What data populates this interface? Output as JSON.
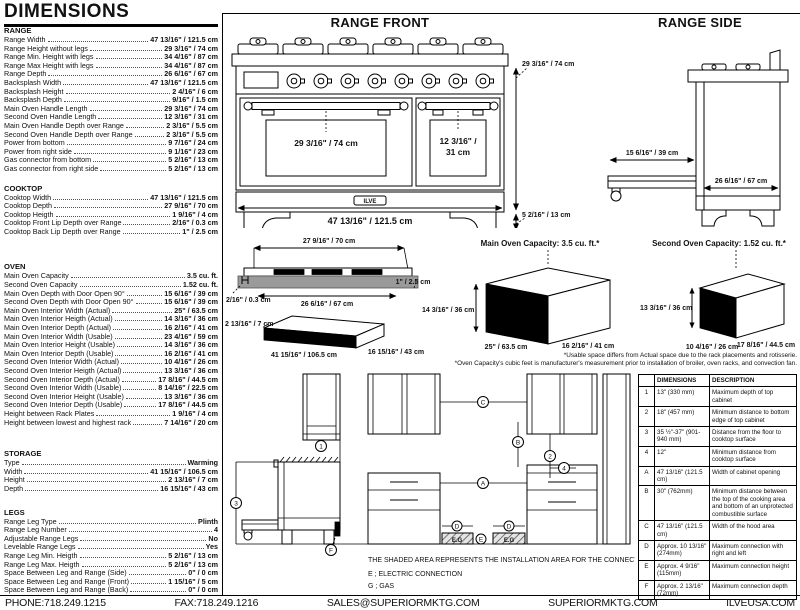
{
  "page": {
    "title": "DIMENSIONS"
  },
  "sections": {
    "range": {
      "heading": "RANGE",
      "rows": [
        {
          "label": "Range Width",
          "value": "47 13/16\" / 121.5 cm"
        },
        {
          "label": "Range Height without legs",
          "value": "29 3/16\" / 74 cm"
        },
        {
          "label": "Range Min. Height with legs",
          "value": "34 4/16\" / 87 cm"
        },
        {
          "label": "Range Max Height with legs",
          "value": "34 4/16\" / 87 cm"
        },
        {
          "label": "Range Depth",
          "value": "26 6/16\" / 67 cm"
        },
        {
          "label": "Backsplash Width",
          "value": "47 13/16\" / 121.5 cm"
        },
        {
          "label": "Backsplash Height",
          "value": "2 4/16\" / 6 cm"
        },
        {
          "label": "Backsplash Depth",
          "value": "9/16\" / 1.5 cm"
        },
        {
          "label": "Main Oven Handle Length",
          "value": "29 3/16\" / 74 cm"
        },
        {
          "label": "Second Oven Handle Length",
          "value": "12 3/16\" / 31 cm"
        },
        {
          "label": "Main Oven Handle Depth over Range",
          "value": "2 3/16\" / 5.5 cm"
        },
        {
          "label": "Second Oven Handle Depth over Range",
          "value": "2 3/16\" / 5.5 cm"
        },
        {
          "label": "Power from bottom",
          "value": "9 7/16\" / 24 cm"
        },
        {
          "label": "Power from right side",
          "value": "9 1/16\" / 23 cm"
        },
        {
          "label": "Gas connector from bottom",
          "value": "5 2/16\" / 13 cm"
        },
        {
          "label": "Gas connector from right side",
          "value": "5 2/16\" / 13 cm"
        }
      ]
    },
    "cooktop": {
      "heading": "COOKTOP",
      "rows": [
        {
          "label": "Cooktop Width",
          "value": "47 13/16\" / 121.5 cm"
        },
        {
          "label": "Cooktop Depth",
          "value": "27 9/16\" / 70 cm"
        },
        {
          "label": "Cooktop Heigth",
          "value": "1 9/16\" / 4 cm"
        },
        {
          "label": "Cooktop Front Lip Depth over Range",
          "value": "2/16\" / 0.3 cm"
        },
        {
          "label": "Cooktop Back Lip Depth over Range",
          "value": "1\" / 2.5 cm"
        }
      ]
    },
    "oven": {
      "heading": "OVEN",
      "rows": [
        {
          "label": "Main Oven Capacity",
          "value": "3.5 cu. ft."
        },
        {
          "label": "Second Oven Capacity",
          "value": "1.52 cu. ft."
        },
        {
          "label": "Main Oven Depth with Door Open 90°",
          "value": "15 6/16\" / 39 cm"
        },
        {
          "label": "Second Oven Depth with Door Open 90°",
          "value": "15 6/16\" / 39 cm"
        },
        {
          "label": "Main Oven Interior Width (Actual)",
          "value": "25\" / 63.5 cm"
        },
        {
          "label": "Main Oven Interior Heigth (Actual)",
          "value": "14 3/16\" / 36 cm"
        },
        {
          "label": "Main Oven Interior Depth (Actual)",
          "value": "16 2/16\" / 41 cm"
        },
        {
          "label": "Main Oven Interior Width (Usable)",
          "value": "23 4/16\" / 59 cm"
        },
        {
          "label": "Main Oven Interior Height (Usable)",
          "value": "14 3/16\" / 36 cm"
        },
        {
          "label": "Main Oven Interior Depth (Usable)",
          "value": "16 2/16\" / 41 cm"
        },
        {
          "label": "Second Oven Interior Width (Actual)",
          "value": "10 4/16\" / 26 cm"
        },
        {
          "label": "Second Oven Interior Heigth (Actual)",
          "value": "13 3/16\" / 36 cm"
        },
        {
          "label": "Second Oven Interior Depth (Actual)",
          "value": "17 8/16\" / 44.5 cm"
        },
        {
          "label": "Second Oven Interior Width (Usable)",
          "value": "8 14/16\" / 22.5 cm"
        },
        {
          "label": "Second Oven Interior Height (Usable)",
          "value": "13 3/16\" / 36 cm"
        },
        {
          "label": "Second Oven Interior Depth (Usable)",
          "value": "17 8/16\" / 44.5 cm"
        },
        {
          "label": "Height between Rack Plates",
          "value": "1 9/16\" / 4 cm"
        },
        {
          "label": "Height between lowest and highest rack",
          "value": "7 14/16\" / 20 cm"
        }
      ]
    },
    "storage": {
      "heading": "STORAGE",
      "rows": [
        {
          "label": "Type",
          "value": "Warming"
        },
        {
          "label": "Width",
          "value": "41 15/16\" / 106.5 cm"
        },
        {
          "label": "Height",
          "value": "2 13/16\" / 7 cm"
        },
        {
          "label": "Depth",
          "value": "16 15/16\" / 43 cm"
        }
      ]
    },
    "legs": {
      "heading": "LEGS",
      "rows": [
        {
          "label": "Range Leg Type",
          "value": "Plinth"
        },
        {
          "label": "Range Leg Number",
          "value": "4"
        },
        {
          "label": "Adjustable Range Legs",
          "value": "No"
        },
        {
          "label": "Levelable Range Legs",
          "value": "Yes"
        },
        {
          "label": "Range Leg Min. Heigth",
          "value": "5 2/16\" / 13 cm"
        },
        {
          "label": "Range Leg Max. Heigth",
          "value": "5 2/16\" / 13 cm"
        },
        {
          "label": "Space Between Leg and Range (Side)",
          "value": "0\" / 0 cm"
        },
        {
          "label": "Space Between Leg and Range (Front)",
          "value": "1 15/16\" / 5 cm"
        },
        {
          "label": "Space Between Leg and Range (Back)",
          "value": "0\" / 0 cm"
        }
      ]
    }
  },
  "drawings": {
    "front": {
      "title": "RANGE FRONT",
      "main_handle": "29 3/16\" / 74 cm",
      "second_handle_l1": "12 3/16\" /",
      "second_handle_l2": "31 cm",
      "width": "47 13/16\" / 121.5 cm",
      "height": "29 3/16\" / 74 cm",
      "leg_height": "5 2/16\" / 13 cm",
      "logo": "ILVE"
    },
    "side": {
      "title": "RANGE SIDE",
      "door_open_depth": "15 6/16\" / 39 cm",
      "depth": "26 6/16\" / 67 cm"
    },
    "cooktop": {
      "width": "27 9/16\" / 70 cm",
      "inner_width": "26 6/16\" / 67 cm",
      "back_lip": "1\" / 2.5 cm",
      "front_lip": "2/16\" / 0.3 cm"
    },
    "storage": {
      "height": "2 13/16\" / 7 cm",
      "width": "41 15/16\" / 106.5 cm",
      "depth": "16 15/16\" / 43 cm"
    },
    "main_oven": {
      "title": "Main Oven Capacity: 3.5 cu. ft.*",
      "height": "14 3/16\" / 36 cm",
      "width": "25\" / 63.5 cm",
      "depth": "16 2/16\" / 41 cm"
    },
    "second_oven": {
      "title": "Second Oven Capacity: 1.52 cu. ft.*",
      "height": "13 3/16\" / 36 cm",
      "width": "10 4/16\" / 26 cm",
      "depth": "17 8/16\" / 44.5 cm"
    },
    "notes": [
      "*Usable space differs from Actual space due to the rack placements and rotisserie.",
      "*Oven Capacity's cubic feet is manufacturer's measurement prior to installation of broiler, oven racks, and convection fan."
    ]
  },
  "installation": {
    "callouts": {
      "one": "1",
      "two": "2",
      "three": "3",
      "four": "4",
      "a": "A",
      "b": "B",
      "c": "C",
      "d": "D",
      "e": "E",
      "f": "F"
    },
    "eg": "E.G",
    "note": "THE SHADED AREA REPRESENTS THE INSTALLATION AREA FOR THE CONNECTIONS;",
    "legend": [
      "E ; ELECTRIC CONNECTION",
      "G ; GAS"
    ],
    "table": {
      "headers": [
        "",
        "DIMENSIONS",
        "DESCRIPTION"
      ],
      "rows": [
        [
          "1",
          "13\" (330 mm)",
          "Maximum depth of top cabinet"
        ],
        [
          "2",
          "18\" (457 mm)",
          "Minimum distance to bottom edge of top cabinet"
        ],
        [
          "3",
          "35 ½\"-37\" (901-940 mm)",
          "Distance from the floor to cooktop surface"
        ],
        [
          "4",
          "12\"",
          "Minimum distance from cooktop surface"
        ],
        [
          "A",
          "47 13/16\" (121.5 cm)",
          "Width of cabinet opening"
        ],
        [
          "B",
          "30\" (762mm)",
          "Minimum distance between the top of the cooking area and bottom of an unprotected combustible surface"
        ],
        [
          "C",
          "47 13/16\" (121.5 cm)",
          "Width of the hood area"
        ],
        [
          "D",
          "Approx. 10 13/16\" (274mm)",
          "Maximum connection with right and left"
        ],
        [
          "E",
          "Approx. 4 9/16\" (115mm)",
          "Maximum connection height"
        ],
        [
          "F",
          "Approx. 2 13/16\" (72mm)",
          "Maximum connection depth"
        ]
      ]
    }
  },
  "footer": {
    "phone": "PHONE:718.249.1215",
    "fax": "FAX:718.249.1216",
    "email": "SALES@SUPERIORMKTG.COM",
    "site": "SUPERIORMKTG.COM",
    "brand": "ILVEUSA.COM"
  }
}
